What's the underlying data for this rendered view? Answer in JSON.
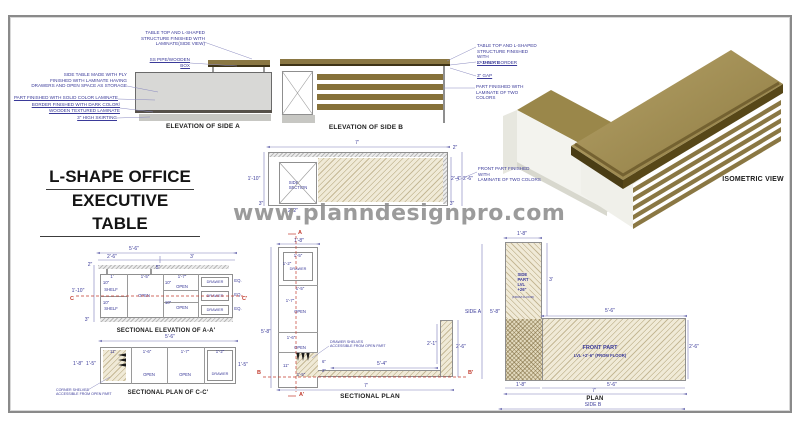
{
  "watermark": "www.planndesignpro.com",
  "title": {
    "line1": "L-SHAPE OFFICE",
    "line2": "EXECUTIVE TABLE"
  },
  "colors": {
    "wood": "#8a7743",
    "wood_dark": "#4f421e",
    "body_gray": "#d8d8d6",
    "hatch_beige": "#f0ead7",
    "dim_blue": "#3a3a99",
    "red": "#c23b2e",
    "watermark_gray": "#8e8e8e"
  },
  "elev_a": {
    "label": "ELEVATION OF SIDE A",
    "ann_tabletop": "TABLE TOP AND L-SHAPED\nSTRUCTURE FINISHED WITH\nLAMINATE(SIDE VIEW)",
    "ann_pipe": "SS PIPE/WOODEN BOX",
    "ann_sidetable": "SIDE TABLE MADE WITH PLY\nFINISHED WITH LAMINATE HAVING\nDRAWERS AND OPEN SPACE AS STORAGE",
    "ann_solid": "PART FINISHED WITH SOLID COLOR LAMINATE",
    "ann_border": "BORDER FINISHED WITH DARK COLOR/\nWOODEN TEXTURED LAMINATE",
    "ann_skirting": "3\" HIGH SKIRTING"
  },
  "elev_b": {
    "label": "ELEVATION OF SIDE B",
    "ann_tabletop": "TABLE TOP AND L-SHAPED\nSTRUCTURE FINISHED WITH\nLAMINATE",
    "ann_border": "2\" THICK BORDER",
    "ann_gap": "3\" GAP",
    "ann_twocolor": "PART FINISHED WITH\nLAMINATE OF TWO COLORS"
  },
  "iso": {
    "label": "ISOMETRIC VIEW"
  },
  "side_section": {
    "label": "SIDE\nSECTION",
    "ann_front": "FRONT PART FINISHED WITH\nLAMINATE OF TWO COLORS",
    "dims": {
      "w": "7'",
      "t2": "2\"",
      "h_left": "1'-10\"",
      "h1": "2'-4\"",
      "h2": "2'-6\"",
      "b_left": "3\"",
      "b_right": "3\"",
      "b_box": "2'-2\""
    }
  },
  "sec_elev": {
    "label": "SECTIONAL ELEVATION OF A-A'",
    "dims": {
      "total": "5'-6\"",
      "left": "2'-6\"",
      "right": "3'",
      "top": "2\"",
      "gap": "5\"",
      "c1": "1'",
      "c2": "1'-5\"",
      "c3": "1'-7\"",
      "ten": "10\"",
      "height": "1'-10\"",
      "skirt": "3\"",
      "eq": "EQ."
    },
    "cells": {
      "shelf": "SHELF",
      "open": "OPEN",
      "drawer": "DRAWER"
    },
    "marker": "C",
    "marker2": "C'"
  },
  "sec_plan_cc": {
    "label": "SECTIONAL PLAN OF C-C'",
    "ann_corner": "CORNER SHELVES\nACCESSIBLE FROM OPEN PART",
    "dims": {
      "total": "5'-6\"",
      "s1": "11\"",
      "s2": "1'-6\"",
      "s3": "1'-7\"",
      "s4": "1'-2\"",
      "l1": "1'-8\"",
      "l2": "1'-5\"",
      "r1": "1'-5\""
    },
    "cells": {
      "open": "OPEN",
      "drawer": "DRAWER"
    }
  },
  "sec_plan": {
    "label": "SECTIONAL PLAN",
    "ann_drawer": "DRAWER SHELVES\nACCESSIBLE FROM OPEN PART",
    "markers": {
      "a": "A",
      "a2": "A'",
      "b": "B",
      "b2": "B'"
    },
    "dims": {
      "top": "1'-8\"",
      "dw": "1'-5\"",
      "dd": "1'-2\"",
      "g1": "1'-5\"",
      "o1": "1'-7\"",
      "height": "5'-8\"",
      "o2": "1'-6\"",
      "b1": "11\"",
      "b2": "1'-5\"",
      "e1": "6\"",
      "e2": "2\"",
      "front": "5'-4\"",
      "r1": "2'-1\"",
      "r2": "2'-6\"",
      "total": "7'"
    },
    "cells": {
      "drawer": "DRAWER",
      "open": "OPEN"
    }
  },
  "plan": {
    "label": "PLAN",
    "side_a": "SIDE A",
    "side_b": "SIDE B",
    "side_part": "SIDE\nPART\nLVL +26\"",
    "side_part_sub": "(FROM FLOOR)",
    "front_part": "FRONT PART",
    "front_lvl": "LVL +2'-6\" (FROM FLOOR)",
    "dims": {
      "top": "1'-8\"",
      "side_len": "3'",
      "height": "5'-8\"",
      "front_w": "5'-6\"",
      "front_d": "2'-6\"",
      "b1": "1'-8\"",
      "b2": "5'-6\"",
      "total": "7'"
    }
  }
}
